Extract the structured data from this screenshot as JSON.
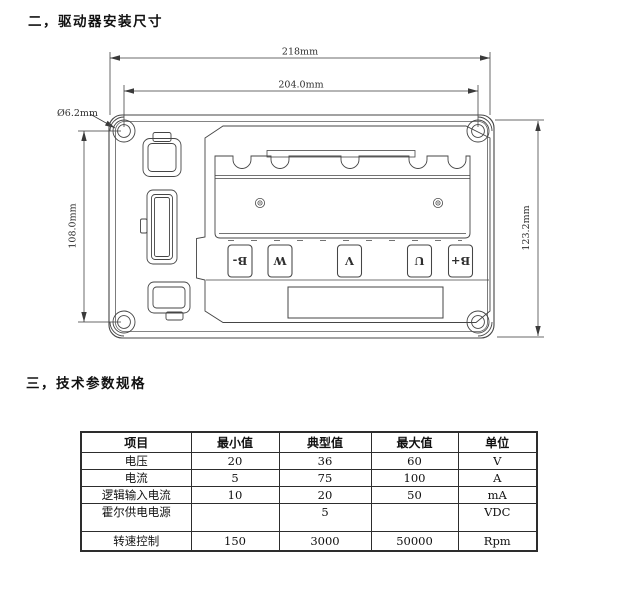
{
  "sections": {
    "installation_title": "二，驱动器安装尺寸",
    "specs_title": "三，技术参数规格"
  },
  "drawing": {
    "dim_overall_width": "218mm",
    "dim_mount_hole_spacing_width": "204.0mm",
    "dim_mount_hole_diameter": "Ø6.2mm",
    "dim_mount_hole_spacing_height": "108.0mm",
    "dim_overall_height": "123.2mm",
    "terminals": [
      "B-",
      "W",
      "V",
      "U",
      "B+"
    ]
  },
  "specs_table": {
    "headers": [
      "项目",
      "最小值",
      "典型值",
      "最大值",
      "单位"
    ],
    "rows": [
      [
        "电压",
        "20",
        "36",
        "60",
        "V"
      ],
      [
        "电流",
        "5",
        "75",
        "100",
        "A"
      ],
      [
        "逻辑输入电流",
        "10",
        "20",
        "50",
        "mA"
      ],
      [
        "霍尔供电电源",
        "",
        "5",
        "",
        "VDC"
      ],
      [
        "转速控制",
        "150",
        "3000",
        "50000",
        "Rpm"
      ]
    ]
  },
  "colors": {
    "ink": "#3a3a3a",
    "paper": "#ffffff"
  }
}
